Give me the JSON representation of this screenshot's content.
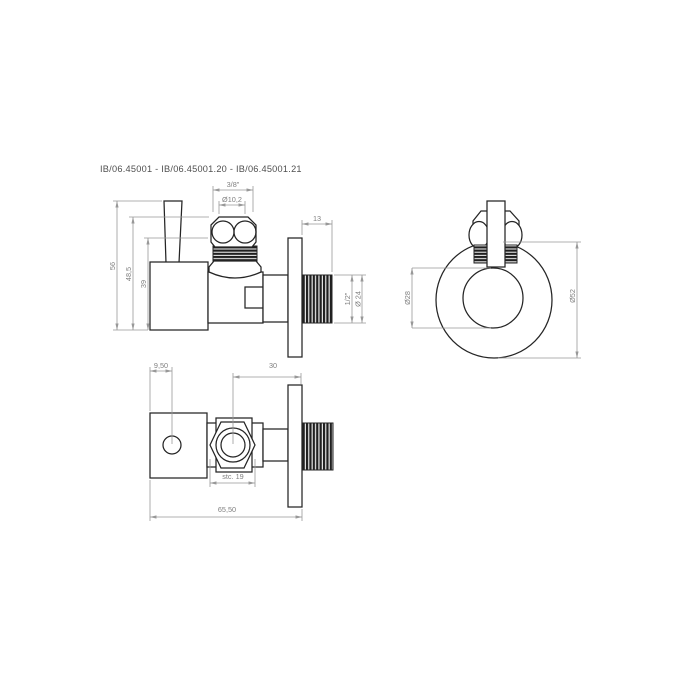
{
  "title": "IB/06.45001 - IB/06.45001.20 - IB/06.45001.21",
  "colors": {
    "object_line": "#252525",
    "dimension_line": "#989898",
    "dimension_text": "#7f7f7f",
    "title_text": "#4f4f4f",
    "background": "#ffffff"
  },
  "views": {
    "side": {
      "dims": {
        "total_height": "56",
        "height_to_nut_top": "48,5",
        "height_to_thread_top": "39",
        "nut_thread_size": "3/8\"",
        "olive_diameter": "Ø10,2",
        "outlet_thread_length": "13",
        "outlet_thread_size": "1/2\"",
        "outlet_diameter": "Ø 24"
      }
    },
    "front": {
      "dims": {
        "inner_diameter": "Ø28",
        "rosette_diameter": "Ø52"
      }
    },
    "top": {
      "dims": {
        "hole_offset": "9,50",
        "axis_to_wall": "30",
        "wrench_size": "stc. 19",
        "total_length": "65,50"
      }
    }
  }
}
